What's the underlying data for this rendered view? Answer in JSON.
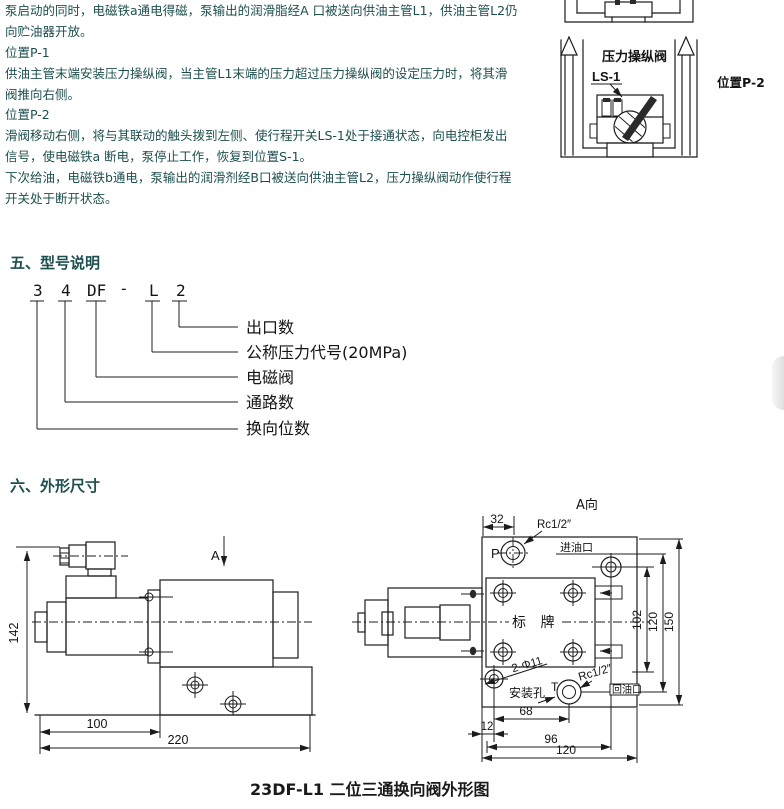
{
  "colors": {
    "body_text": "#1d4e4e",
    "line_art": "#1c1c1c"
  },
  "intro": {
    "lines": [
      "泵启动的同时，电磁铁a通电得磁，泵输出的润滑脂经A 口被送向供油主管L1，供油主管L2仍",
      "向贮油器开放。",
      "位置P-1",
      "供油主管末端安装压力操纵阀，当主管L1末端的压力超过压力操纵阀的设定压力时，将其滑",
      "阀推向右侧。",
      "位置P-2",
      "滑阀移动右侧，将与其联动的触头拨到左侧、使行程开关LS-1处于接通状态，向电控柜发出",
      "信号，使电磁铁a 断电，泵停止工作，恢复到位置S-1。",
      "下次给油，电磁铁b通电，泵输出的润滑剂经B口被送向供油主管L2，压力操纵阀动作使行程",
      "开关处于断开状态。"
    ]
  },
  "p2": {
    "valve_title": "压力操纵阀",
    "switch_label": "LS-1",
    "position_label": "位置P-2"
  },
  "model": {
    "heading": "五、型号说明",
    "code": [
      "3",
      "4",
      "DF",
      "-",
      "L",
      "2"
    ],
    "meanings": [
      "出口数",
      "公称压力代号(20MPa)",
      "电磁阀",
      "通路数",
      "换向位数"
    ]
  },
  "outline": {
    "heading": "六、外形尺寸",
    "caption": "23DF-L1 二位三通换向阀外形图",
    "side": {
      "view": "A",
      "dim_height": "142",
      "dim_front": "100",
      "dim_total": "220"
    },
    "top": {
      "title": "A向",
      "dim_32": "32",
      "port_p": "P",
      "thread_top": "Rc1/2″",
      "inlet": "进油口",
      "nameplate": "标 牌",
      "holes": "2-Φ11",
      "mount": "安装孔",
      "port_t": "T",
      "thread_bottom": "Rc1/2″",
      "outlet": "回油口",
      "dim_102": "102",
      "dim_120_v": "120",
      "dim_150": "150",
      "dim_68": "68",
      "dim_12": "12",
      "dim_96": "96",
      "dim_120_h": "120"
    }
  }
}
